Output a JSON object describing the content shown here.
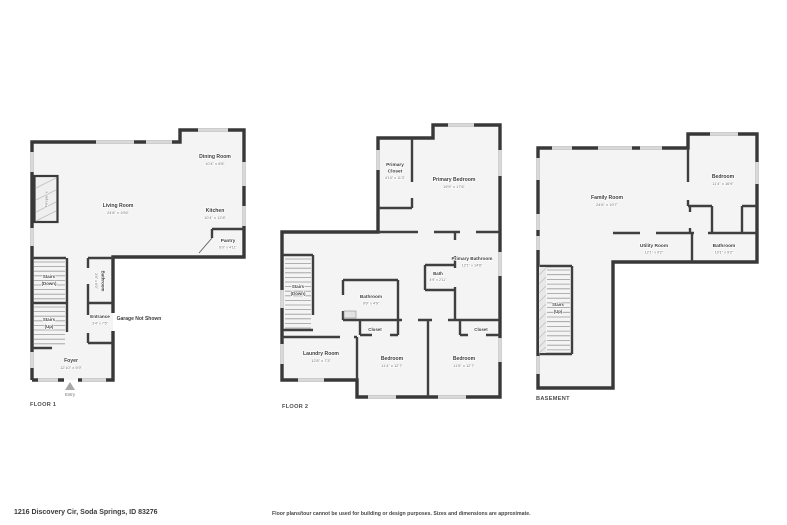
{
  "address": "1216 Discovery Cir, Soda Springs, ID 83276",
  "disclaimer": "Floor plans/tour cannot be used for building or design purposes. Sizes and dimensions are approximate.",
  "f1": {
    "floor_label": "FLOOR 1",
    "living": {
      "name": "Living Room",
      "dims": "24'8\" x 19'6\""
    },
    "dining": {
      "name": "Dining Room",
      "dims": "10'4\" x 8'8\""
    },
    "kitchen": {
      "name": "Kitchen",
      "dims": "10'4\" x 12'8\""
    },
    "pantry": {
      "name": "Pantry",
      "dims": "6'0\" x 4'11\""
    },
    "bathroom": {
      "name": "Bathroom",
      "dims": "3'6\" x 6'0\""
    },
    "entrance": {
      "name": "Entrance",
      "dims": "3'4\" x 7'5\""
    },
    "foyer": {
      "name": "Foyer",
      "dims": "12'10\" x 5'9\""
    },
    "stairs_down": {
      "l1": "Stairs",
      "l2": "(Down)"
    },
    "stairs_up": {
      "l1": "Stairs",
      "l2": "(Up)"
    },
    "garage_note": "Garage Not Shown",
    "fireplace": "Fireplace",
    "entry": "Entry"
  },
  "f2": {
    "floor_label": "FLOOR 2",
    "primary_closet": {
      "n1": "Primary",
      "n2": "Closet",
      "dims": "4'10\" x 11'3\""
    },
    "primary_bedroom": {
      "name": "Primary Bedroom",
      "dims": "19'9\" x 17'6\""
    },
    "primary_bathroom": {
      "name": "Primary Bathroom",
      "dims": "12'1\" x 14'6\""
    },
    "bath": {
      "name": "Bath",
      "dims": "4'9\" x 2'11\""
    },
    "bathroom": {
      "name": "Bathroom",
      "dims": "9'9\" x 4'9\""
    },
    "laundry": {
      "name": "Laundry Room",
      "dims": "12'8\" x 7'3\""
    },
    "bedroom1": {
      "name": "Bedroom",
      "dims": "11'4\" x 12'7\""
    },
    "bedroom2": {
      "name": "Bedroom",
      "dims": "11'5\" x 12'7\""
    },
    "closet1": "Closet",
    "closet2": "Closet",
    "stairs_down": {
      "l1": "Stairs",
      "l2": "(Down)"
    }
  },
  "bsmt": {
    "floor_label": "BASEMENT",
    "family": {
      "name": "Family Room",
      "dims": "24'6\" x 19'7\""
    },
    "bedroom": {
      "name": "Bedroom",
      "dims": "11'4\" x 16'9\""
    },
    "utility": {
      "name": "Utility Room",
      "dims": "12'1\" x 9'2\""
    },
    "bathroom": {
      "name": "Bathroom",
      "dims": "10'1\" x 9'2\""
    },
    "stairs_up": {
      "l1": "Stairs",
      "l2": "(Up)"
    }
  }
}
